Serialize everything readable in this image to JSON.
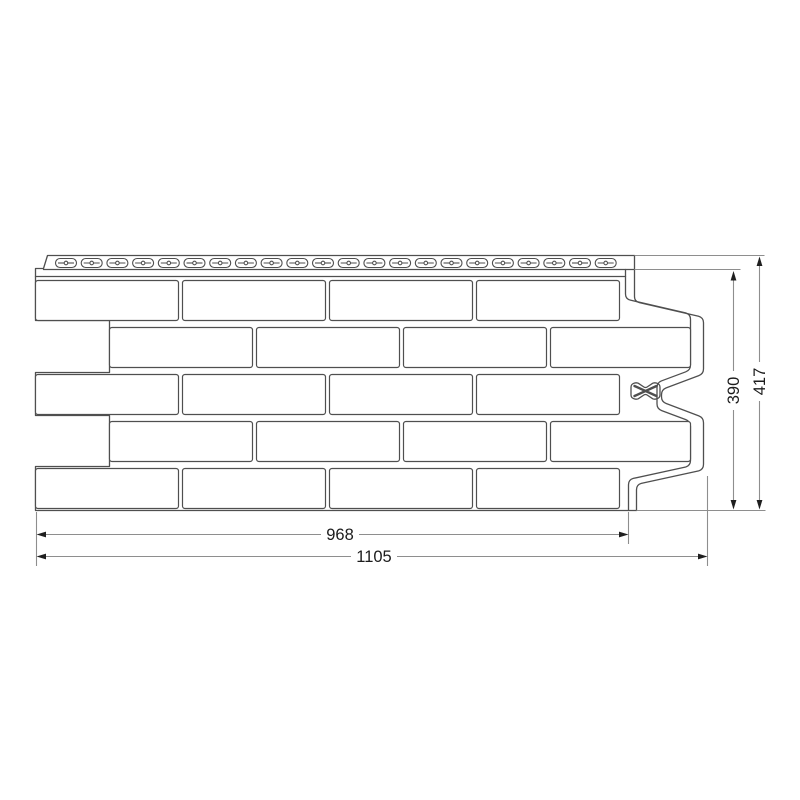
{
  "background": "#ffffff",
  "colors": {
    "panel_line": "#4f4f4f",
    "dimension_line": "#8e8e8e",
    "arrow": "#1f1f1f",
    "text": "#1c1c1c"
  },
  "drawing": {
    "type": "brick-facade-panel-technical-drawing",
    "dimensions": {
      "face_width": "968",
      "overall_width": "1105",
      "face_height": "390",
      "overall_height": "417"
    },
    "panel": {
      "brick_rows": 5,
      "bricks_per_full_row": 4,
      "perforation_count": 22
    }
  }
}
